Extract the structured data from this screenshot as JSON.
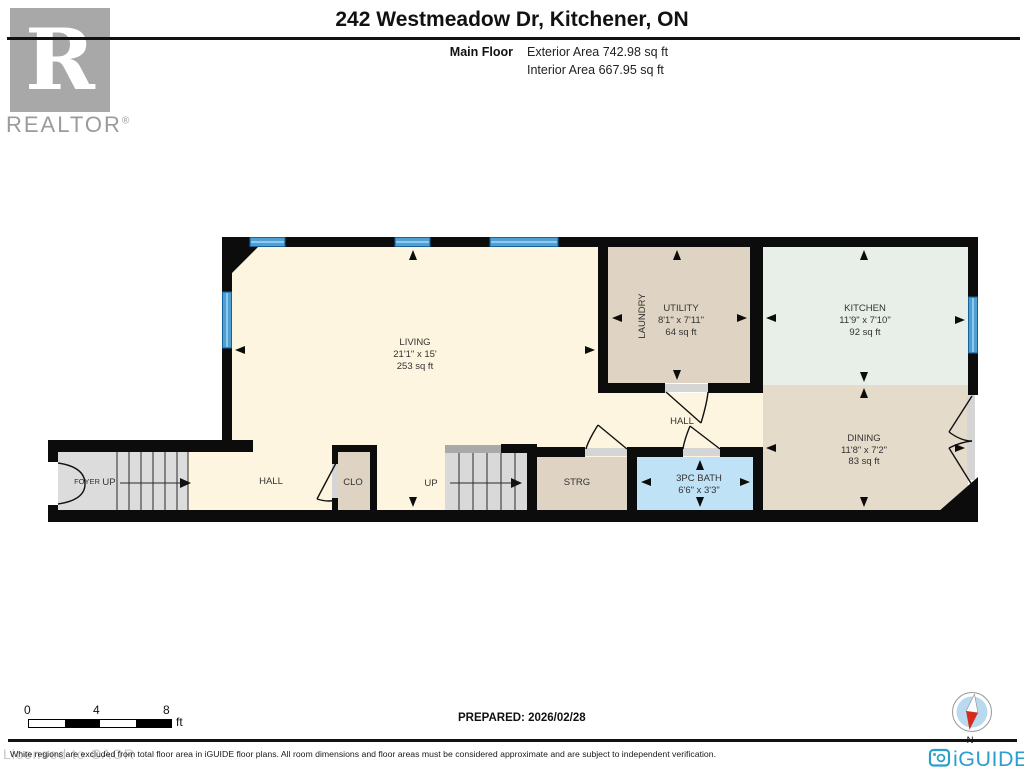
{
  "header": {
    "realtor_logo_letter": "R",
    "realtor_logo_text": "REALTOR",
    "realtor_reg_mark": "®",
    "title": "242 Westmeadow Dr, Kitchener, ON",
    "floor_label": "Main Floor",
    "exterior_area": "Exterior Area 742.98 sq ft",
    "interior_area": "Interior Area 667.95 sq ft"
  },
  "plan": {
    "living": {
      "name": "LIVING",
      "dims": "21'1\" x 15'",
      "area": "253 sq ft"
    },
    "utility": {
      "name": "UTILITY",
      "dims": "8'1\" x 7'11\"",
      "area": "64 sq ft"
    },
    "laundry_label": "LAUNDRY",
    "kitchen": {
      "name": "KITCHEN",
      "dims": "11'9\" x 7'10\"",
      "area": "92 sq ft"
    },
    "dining": {
      "name": "DINING",
      "dims": "11'8\" x 7'2\"",
      "area": "83 sq ft"
    },
    "bath": {
      "name": "3PC BATH",
      "dims": "6'6\" x 3'3\""
    },
    "hall_center_label": "HALL",
    "hall_left_label": "HALL",
    "foyer_label": "FOYER",
    "foyer_up_label": "UP",
    "stairs_up_label": "UP",
    "closet_label": "CLO",
    "storage_label": "STRG"
  },
  "footer": {
    "scale_ticks": [
      "0",
      "4",
      "8"
    ],
    "scale_unit": "ft",
    "prepared": "PREPARED: 2026/02/28",
    "compass_north_label": "N",
    "watermark": "Licensed to CAOR",
    "disclaimer": "White regions are excluded from total floor area in iGUIDE floor plans. All room dimensions and floor areas must be considered approximate and are subject to independent verification.",
    "brand": "iGUIDE"
  },
  "colors": {
    "wall": "#0c0c0c",
    "floor_cream": "#fdf5df",
    "floor_tan": "#dfd4c3",
    "floor_dining_tan": "#e4dbca",
    "floor_mint": "#e7efe8",
    "floor_bath_blue": "#bfe2f7",
    "floor_gray": "#dcdcdc",
    "stair_cap_gray": "#a9a9a9",
    "window_blue": "#4d9fd4",
    "brand_blue": "#2d9ecd",
    "realtor_gray": "#a8a8a8"
  }
}
